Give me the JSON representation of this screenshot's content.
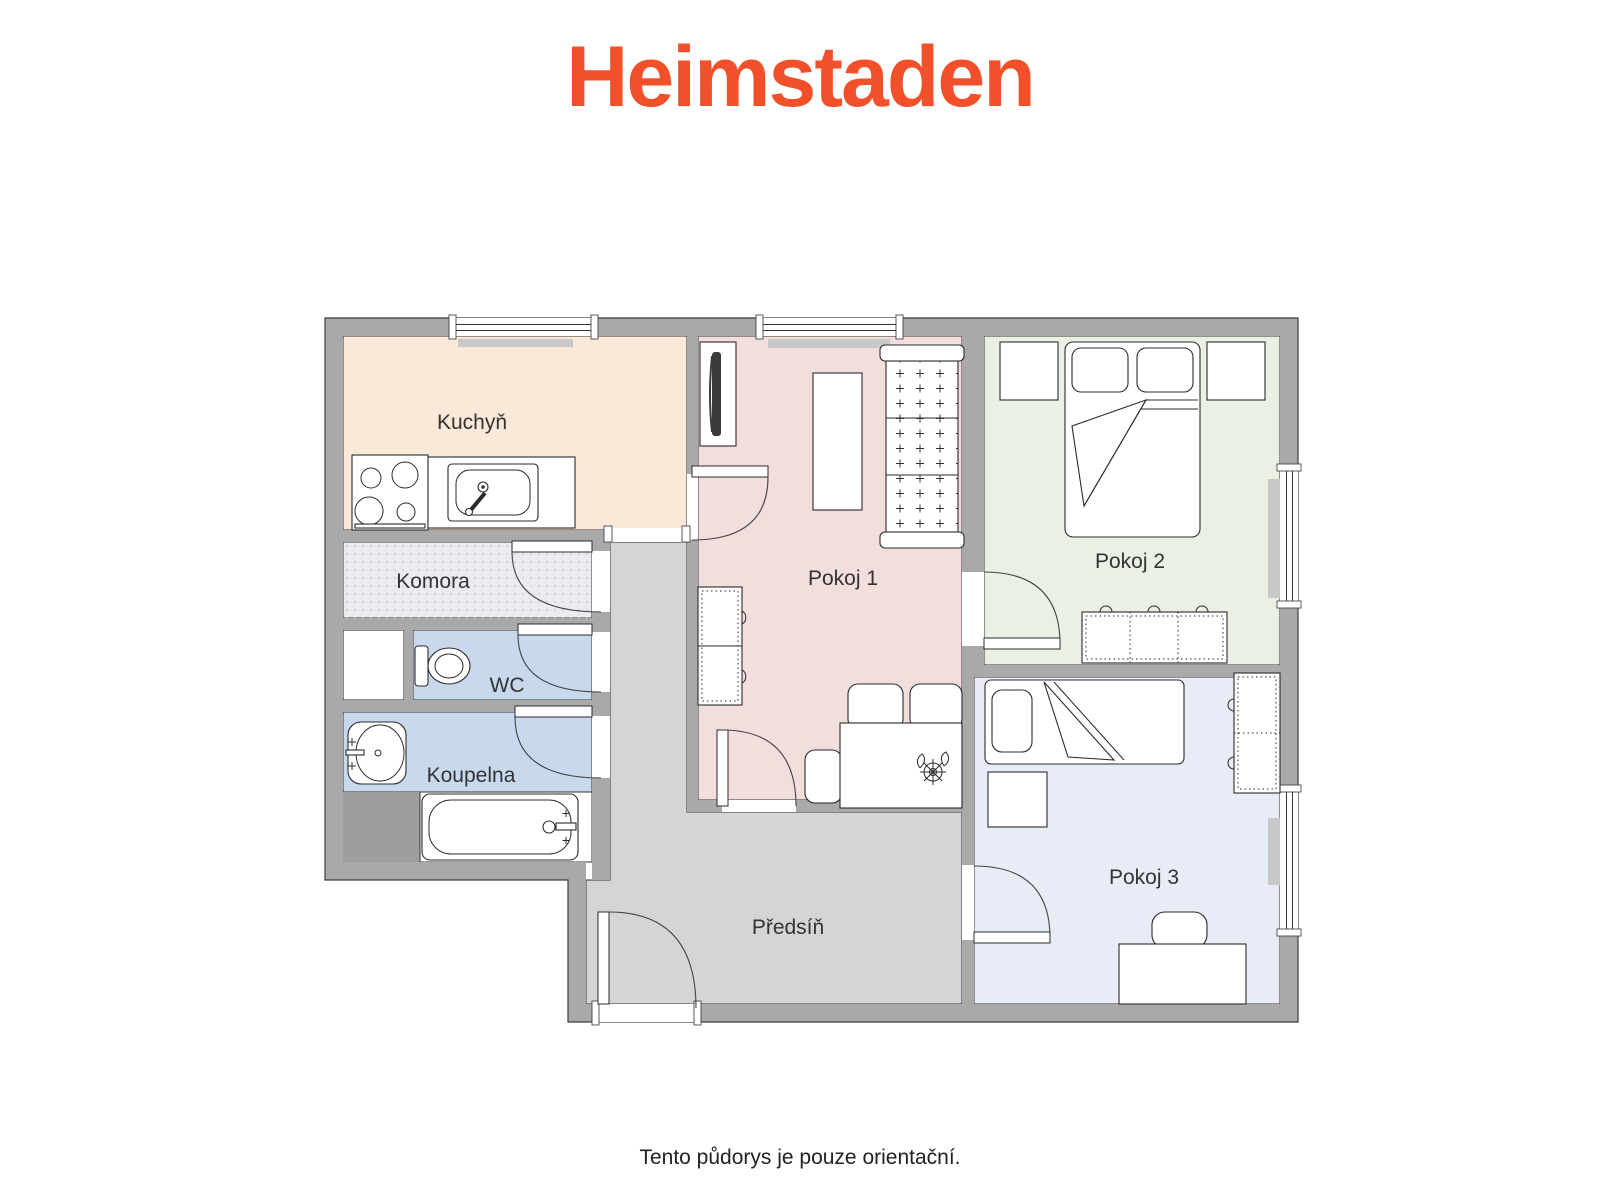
{
  "logo": {
    "text": "Heimstaden",
    "color": "#F1502B"
  },
  "disclaimer": "Tento půdorys je pouze orientační.",
  "floorplan": {
    "wall_color": "#A9A9A9",
    "hall_floor_color": "#D5D5D5",
    "rooms": {
      "kuchyn": {
        "label": "Kuchyň",
        "color": "#FAE8D9"
      },
      "komora": {
        "label": "Komora",
        "color": "#ECEBF2"
      },
      "wc": {
        "label": "WC",
        "color": "#C8D9EE"
      },
      "koupelna": {
        "label": "Koupelna",
        "color": "#C8D9EE"
      },
      "pokoj1": {
        "label": "Pokoj 1",
        "color": "#F2DEDD"
      },
      "pokoj2": {
        "label": "Pokoj 2",
        "color": "#EAF0E3"
      },
      "pokoj3": {
        "label": "Pokoj 3",
        "color": "#E8ECF6"
      },
      "predsin": {
        "label": "Předsíň",
        "color": "#D5D5D5"
      }
    },
    "furniture": {
      "kuchyn": [
        "stove",
        "kitchen-sink",
        "counter",
        "radiator"
      ],
      "wc": [
        "toilet",
        "shaft"
      ],
      "koupelna": [
        "washbasin",
        "bathtub"
      ],
      "pokoj1": [
        "tv",
        "coffee-table",
        "sofa",
        "wardrobe",
        "dining-table",
        "chairs",
        "plant",
        "radiator"
      ],
      "pokoj2": [
        "double-bed",
        "pillows",
        "nightstands",
        "wardrobe",
        "radiator"
      ],
      "pokoj3": [
        "single-bed",
        "pillow",
        "nightstand",
        "wardrobe",
        "desk",
        "desk-chair",
        "radiator"
      ],
      "predsin": [
        "entrance-door"
      ]
    }
  }
}
